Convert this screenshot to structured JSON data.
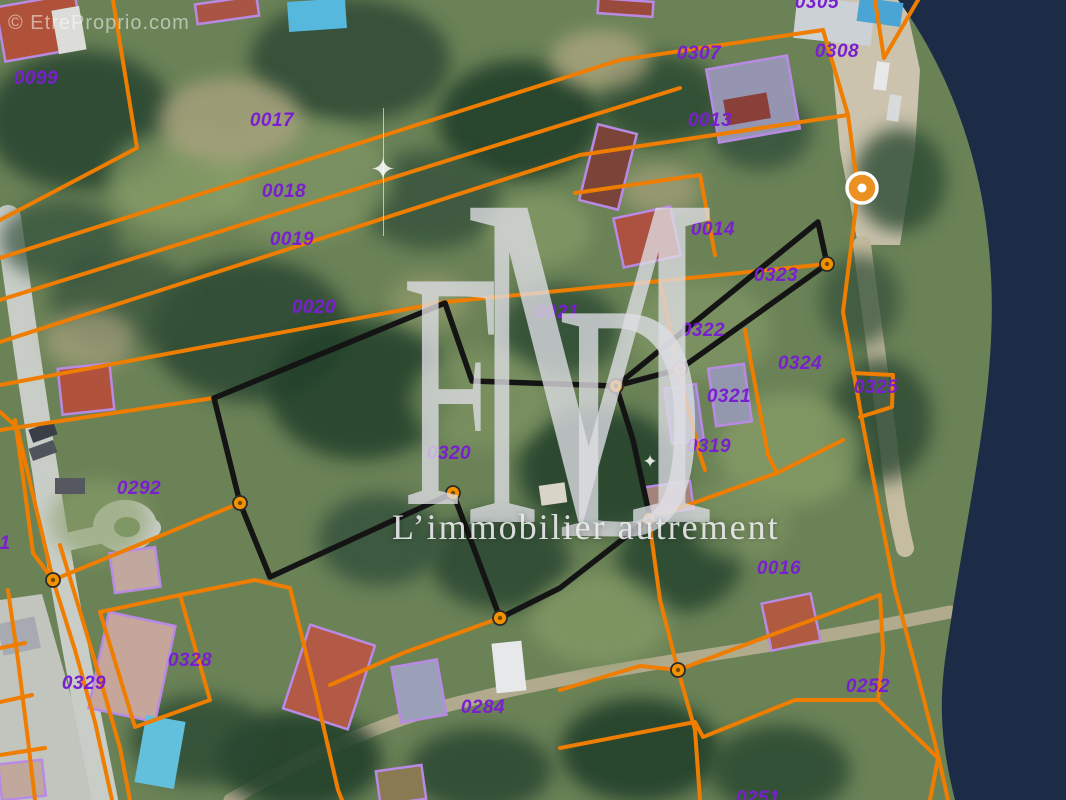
{
  "watermark": {
    "copyright": "© EtreProprio.com",
    "logo_f": "F",
    "logo_m": "M",
    "logo_d": "D",
    "tagline": "L’immobilier autrement",
    "sparkle_glyph": "✦"
  },
  "labels": {
    "color": "#7a1fd0",
    "items": [
      {
        "t": "0099",
        "x": 36,
        "y": 79
      },
      {
        "t": "0017",
        "x": 272,
        "y": 121
      },
      {
        "t": "0018",
        "x": 284,
        "y": 192
      },
      {
        "t": "0019",
        "x": 292,
        "y": 240
      },
      {
        "t": "0020",
        "x": 314,
        "y": 308
      },
      {
        "t": "0021",
        "x": 557,
        "y": 313
      },
      {
        "t": "0305",
        "x": 817,
        "y": 3
      },
      {
        "t": "0307",
        "x": 699,
        "y": 54
      },
      {
        "t": "0308",
        "x": 837,
        "y": 52
      },
      {
        "t": "0013",
        "x": 710,
        "y": 121
      },
      {
        "t": "0014",
        "x": 713,
        "y": 230
      },
      {
        "t": "0323",
        "x": 776,
        "y": 276
      },
      {
        "t": "0322",
        "x": 703,
        "y": 331
      },
      {
        "t": "0324",
        "x": 800,
        "y": 364
      },
      {
        "t": "0325",
        "x": 876,
        "y": 388
      },
      {
        "t": "0321",
        "x": 729,
        "y": 397
      },
      {
        "t": "0319",
        "x": 709,
        "y": 447
      },
      {
        "t": "0320",
        "x": 449,
        "y": 454
      },
      {
        "t": "0292",
        "x": 139,
        "y": 489
      },
      {
        "t": "1",
        "x": 5,
        "y": 544
      },
      {
        "t": "0329",
        "x": 84,
        "y": 684
      },
      {
        "t": "0328",
        "x": 190,
        "y": 661
      },
      {
        "t": "0284",
        "x": 483,
        "y": 708
      },
      {
        "t": "0016",
        "x": 779,
        "y": 569
      },
      {
        "t": "0252",
        "x": 868,
        "y": 687
      },
      {
        "t": "0251",
        "x": 758,
        "y": 799
      }
    ]
  },
  "marker": {
    "x": 862,
    "y": 188,
    "r": 15,
    "color": "#ea9122",
    "ring": "#ffffff",
    "dot": "#ffffff"
  },
  "terrain": {
    "base": "#6b8257",
    "blobs": [
      [
        80,
        120,
        95,
        70,
        "#2c4632",
        0.9
      ],
      [
        350,
        60,
        100,
        62,
        "#2e4a35",
        0.85
      ],
      [
        520,
        120,
        82,
        60,
        "#24402c",
        0.9
      ],
      [
        430,
        200,
        70,
        50,
        "#35513a",
        0.8
      ],
      [
        660,
        100,
        62,
        46,
        "#2c4833",
        0.85
      ],
      [
        760,
        130,
        52,
        40,
        "#31503a",
        0.8
      ],
      [
        250,
        330,
        100,
        72,
        "#2a4630",
        0.85
      ],
      [
        360,
        390,
        92,
        70,
        "#24402c",
        0.85
      ],
      [
        120,
        300,
        70,
        50,
        "#35513a",
        0.7
      ],
      [
        560,
        330,
        60,
        45,
        "#2c4833",
        0.8
      ],
      [
        600,
        470,
        82,
        62,
        "#24402c",
        0.85
      ],
      [
        500,
        560,
        70,
        50,
        "#2a4630",
        0.85
      ],
      [
        380,
        540,
        62,
        46,
        "#31503a",
        0.8
      ],
      [
        680,
        560,
        62,
        52,
        "#28442f",
        0.85
      ],
      [
        300,
        760,
        82,
        50,
        "#24402c",
        0.9
      ],
      [
        200,
        740,
        70,
        45,
        "#2c4833",
        0.8
      ],
      [
        480,
        770,
        72,
        42,
        "#2a4630",
        0.85
      ],
      [
        640,
        750,
        80,
        52,
        "#24402c",
        0.9
      ],
      [
        780,
        770,
        70,
        45,
        "#2c4833",
        0.85
      ],
      [
        880,
        420,
        52,
        62,
        "#2a4630",
        0.8
      ],
      [
        900,
        180,
        46,
        52,
        "#2c4833",
        0.8
      ],
      [
        860,
        300,
        40,
        46,
        "#35513a",
        0.75
      ],
      [
        60,
        240,
        60,
        40,
        "#31503a",
        0.7
      ],
      [
        300,
        180,
        92,
        60,
        "#7e9464",
        0.8
      ],
      [
        180,
        180,
        72,
        50,
        "#8aa06a",
        0.7
      ],
      [
        700,
        330,
        72,
        50,
        "#7e9464",
        0.8
      ],
      [
        790,
        450,
        72,
        56,
        "#869c66",
        0.8
      ],
      [
        480,
        400,
        70,
        50,
        "#7e9464",
        0.7
      ],
      [
        600,
        620,
        70,
        45,
        "#869c66",
        0.7
      ],
      [
        100,
        520,
        50,
        40,
        "#8aa06a",
        0.6
      ],
      [
        740,
        520,
        50,
        40,
        "#7e9464",
        0.7
      ],
      [
        540,
        230,
        52,
        36,
        "#8aa06a",
        0.6
      ],
      [
        230,
        120,
        72,
        42,
        "#a9a37e",
        0.8
      ],
      [
        600,
        60,
        50,
        30,
        "#b5ab84",
        0.7
      ],
      [
        90,
        340,
        46,
        30,
        "#a9a37e",
        0.7
      ],
      [
        660,
        190,
        40,
        25,
        "#b0a680",
        0.6
      ],
      [
        430,
        300,
        40,
        26,
        "#9aa070",
        0.6
      ]
    ]
  },
  "water": {
    "river": "M898,0 L1066,0 L1066,800 L955,800 C940,740 938,700 948,640 C958,570 972,500 982,430 C992,360 995,300 988,240 C980,160 950,70 898,0 Z",
    "color": "#1c2c46"
  },
  "ground": {
    "fills": [
      {
        "d": "M828,0 L905,0 L920,70 L915,150 L900,245 L858,245 L840,150 L832,60 Z",
        "fill": "#cbc3ad"
      },
      {
        "d": "M0,600 L42,594 L72,700 L96,800 L0,800 Z",
        "fill": "#c2c4be"
      }
    ],
    "strokes": [
      {
        "d": "M8,218 C20,300 30,380 45,470 C55,540 70,620 85,700 C95,750 100,775 105,800",
        "c": "#c9cdc7",
        "w": 26
      },
      {
        "d": "M55,545 C90,536 115,531 152,528",
        "c": "#c9cdc7",
        "w": 18
      },
      {
        "d": "M230,800 C300,760 380,720 470,700 C580,672 700,658 800,640 C860,630 900,622 950,612",
        "c": "#b1aa8d",
        "w": 13
      },
      {
        "d": "M862,245 C870,305 880,380 888,440 C893,490 898,520 905,548",
        "c": "#c6bda0",
        "w": 18
      }
    ],
    "ellipses": [
      {
        "cx": 125,
        "cy": 526,
        "rx": 32,
        "ry": 26,
        "fill": "#c9cdc7"
      },
      {
        "cx": 127,
        "cy": 527,
        "rx": 13,
        "ry": 10,
        "fill": "#6f8a5c"
      }
    ]
  },
  "buildings": {
    "outline": "#b98ae4",
    "items": [
      [
        0,
        0,
        80,
        55,
        -10,
        "#b0523a",
        true
      ],
      [
        55,
        8,
        28,
        44,
        -10,
        "#dcdcd8",
        false
      ],
      [
        196,
        0,
        62,
        20,
        -8,
        "#a85545",
        true
      ],
      [
        288,
        0,
        58,
        30,
        -4,
        "#55b8dc",
        false
      ],
      [
        598,
        0,
        55,
        15,
        4,
        "#9a4a3a",
        true
      ],
      [
        795,
        0,
        78,
        42,
        6,
        "#ccd1d6",
        false
      ],
      [
        858,
        0,
        44,
        24,
        8,
        "#4aa4d4",
        false
      ],
      [
        712,
        62,
        82,
        74,
        -10,
        "#9595b2",
        true
      ],
      [
        725,
        96,
        44,
        26,
        -10,
        "#8a4038",
        false
      ],
      [
        588,
        128,
        40,
        78,
        14,
        "#7a4438",
        true
      ],
      [
        618,
        212,
        58,
        50,
        -12,
        "#ad5240",
        true
      ],
      [
        60,
        366,
        52,
        46,
        -6,
        "#b0523c",
        true
      ],
      [
        112,
        550,
        46,
        40,
        -8,
        "#c0a89e",
        true
      ],
      [
        98,
        618,
        68,
        98,
        12,
        "#c6a59b",
        true
      ],
      [
        140,
        718,
        40,
        68,
        10,
        "#62c0dc",
        false
      ],
      [
        0,
        620,
        38,
        32,
        -12,
        "#a8aab2",
        false
      ],
      [
        0,
        762,
        44,
        36,
        -6,
        "#c0a89c",
        true
      ],
      [
        295,
        633,
        68,
        88,
        18,
        "#b25a46",
        true
      ],
      [
        396,
        663,
        46,
        56,
        -10,
        "#9aa0b8",
        true
      ],
      [
        494,
        642,
        30,
        50,
        -6,
        "#e6e8ea",
        false
      ],
      [
        766,
        598,
        50,
        48,
        -12,
        "#b05a42",
        true
      ],
      [
        668,
        386,
        32,
        56,
        -8,
        "#8a90a8",
        true
      ],
      [
        712,
        366,
        36,
        58,
        -8,
        "#9398ae",
        true
      ],
      [
        646,
        484,
        46,
        28,
        -8,
        "#a28578",
        true
      ],
      [
        55,
        478,
        30,
        16,
        0,
        "#55585e",
        false
      ],
      [
        875,
        62,
        13,
        28,
        8,
        "#e8e8ea",
        false
      ],
      [
        888,
        95,
        12,
        26,
        8,
        "#d8dadc",
        false
      ],
      [
        30,
        425,
        26,
        14,
        -20,
        "#3a3e46",
        false
      ],
      [
        30,
        444,
        26,
        13,
        -20,
        "#50545c",
        false
      ],
      [
        378,
        768,
        46,
        34,
        -8,
        "#8a7a52",
        true
      ],
      [
        540,
        484,
        26,
        20,
        -8,
        "#d8d4c8",
        false
      ]
    ]
  },
  "lines": {
    "orange": {
      "color": "#ee7d00",
      "width": 4,
      "polys": [
        [
          [
            113,
            0
          ],
          [
            137,
            148
          ],
          [
            0,
            220
          ]
        ],
        [
          [
            0,
            258
          ],
          [
            620,
            60
          ],
          [
            823,
            30
          ]
        ],
        [
          [
            0,
            300
          ],
          [
            680,
            88
          ]
        ],
        [
          [
            0,
            342
          ],
          [
            580,
            155
          ],
          [
            848,
            115
          ]
        ],
        [
          [
            0,
            385
          ],
          [
            445,
            302
          ],
          [
            660,
            281
          ],
          [
            827,
            264
          ]
        ],
        [
          [
            0,
            430
          ],
          [
            214,
            398
          ],
          [
            445,
            303
          ]
        ],
        [
          [
            823,
            30
          ],
          [
            848,
            115
          ]
        ],
        [
          [
            875,
            0
          ],
          [
            884,
            58
          ],
          [
            918,
            0
          ]
        ],
        [
          [
            848,
            115
          ],
          [
            858,
            190
          ],
          [
            843,
            312
          ],
          [
            862,
            420
          ],
          [
            880,
            513
          ],
          [
            895,
            590
          ],
          [
            915,
            665
          ],
          [
            938,
            755
          ],
          [
            948,
            800
          ]
        ],
        [
          [
            853,
            373
          ],
          [
            893,
            375
          ],
          [
            892,
            407
          ],
          [
            860,
            417
          ]
        ],
        [
          [
            575,
            193
          ],
          [
            700,
            175
          ],
          [
            715,
            255
          ]
        ],
        [
          [
            660,
            281
          ],
          [
            678,
            369
          ],
          [
            700,
            455
          ],
          [
            705,
            470
          ]
        ],
        [
          [
            745,
            330
          ],
          [
            768,
            455
          ],
          [
            777,
            473
          ]
        ],
        [
          [
            649,
            519
          ],
          [
            777,
            473
          ],
          [
            843,
            440
          ]
        ],
        [
          [
            649,
            519
          ],
          [
            660,
            600
          ],
          [
            678,
            670
          ]
        ],
        [
          [
            678,
            670
          ],
          [
            640,
            666
          ],
          [
            560,
            690
          ]
        ],
        [
          [
            678,
            670
          ],
          [
            695,
            730
          ],
          [
            700,
            800
          ]
        ],
        [
          [
            678,
            670
          ],
          [
            790,
            628
          ],
          [
            880,
            595
          ]
        ],
        [
          [
            880,
            595
          ],
          [
            883,
            650
          ],
          [
            878,
            700
          ]
        ],
        [
          [
            560,
            748
          ],
          [
            695,
            722
          ],
          [
            703,
            737
          ],
          [
            795,
            700
          ],
          [
            878,
            700
          ]
        ],
        [
          [
            878,
            700
          ],
          [
            938,
            758
          ],
          [
            930,
            800
          ]
        ],
        [
          [
            33,
            553
          ],
          [
            53,
            580
          ],
          [
            75,
            650
          ],
          [
            95,
            722
          ],
          [
            112,
            800
          ]
        ],
        [
          [
            60,
            545
          ],
          [
            82,
            618
          ],
          [
            102,
            685
          ],
          [
            120,
            748
          ],
          [
            130,
            800
          ]
        ],
        [
          [
            53,
            580
          ],
          [
            240,
            503
          ]
        ],
        [
          [
            53,
            580
          ],
          [
            17,
            427
          ],
          [
            0,
            412
          ]
        ],
        [
          [
            33,
            553
          ],
          [
            22,
            470
          ],
          [
            15,
            420
          ]
        ],
        [
          [
            100,
            612
          ],
          [
            180,
            595
          ],
          [
            210,
            700
          ],
          [
            135,
            727
          ],
          [
            100,
            612
          ]
        ],
        [
          [
            180,
            595
          ],
          [
            255,
            580
          ],
          [
            290,
            588
          ]
        ],
        [
          [
            290,
            588
          ],
          [
            315,
            690
          ],
          [
            338,
            790
          ],
          [
            342,
            800
          ]
        ],
        [
          [
            500,
            618
          ],
          [
            403,
            653
          ],
          [
            330,
            685
          ]
        ],
        [
          [
            8,
            590
          ],
          [
            18,
            660
          ],
          [
            28,
            740
          ],
          [
            35,
            800
          ]
        ],
        [
          [
            0,
            648
          ],
          [
            25,
            643
          ]
        ],
        [
          [
            0,
            702
          ],
          [
            32,
            695
          ]
        ],
        [
          [
            0,
            755
          ],
          [
            45,
            748
          ]
        ]
      ]
    },
    "black": {
      "color": "#141414",
      "width": 5.5,
      "polys": [
        [
          [
            616,
            386
          ],
          [
            633,
            440
          ],
          [
            650,
            518
          ],
          [
            560,
            588
          ],
          [
            500,
            618
          ],
          [
            453,
            493
          ],
          [
            270,
            577
          ],
          [
            240,
            503
          ],
          [
            214,
            398
          ],
          [
            445,
            303
          ],
          [
            472,
            381
          ],
          [
            616,
            386
          ]
        ],
        [
          [
            616,
            386
          ],
          [
            680,
            369
          ],
          [
            827,
            264
          ],
          [
            818,
            222
          ],
          [
            616,
            386
          ]
        ]
      ]
    },
    "dots": {
      "fill": "#f39200",
      "ring": "#2a2a2a",
      "r": 7,
      "pts": [
        [
          827,
          264
        ],
        [
          680,
          369
        ],
        [
          616,
          386
        ],
        [
          240,
          503
        ],
        [
          453,
          493
        ],
        [
          500,
          618
        ],
        [
          53,
          580
        ],
        [
          678,
          670
        ],
        [
          649,
          519
        ]
      ]
    }
  }
}
